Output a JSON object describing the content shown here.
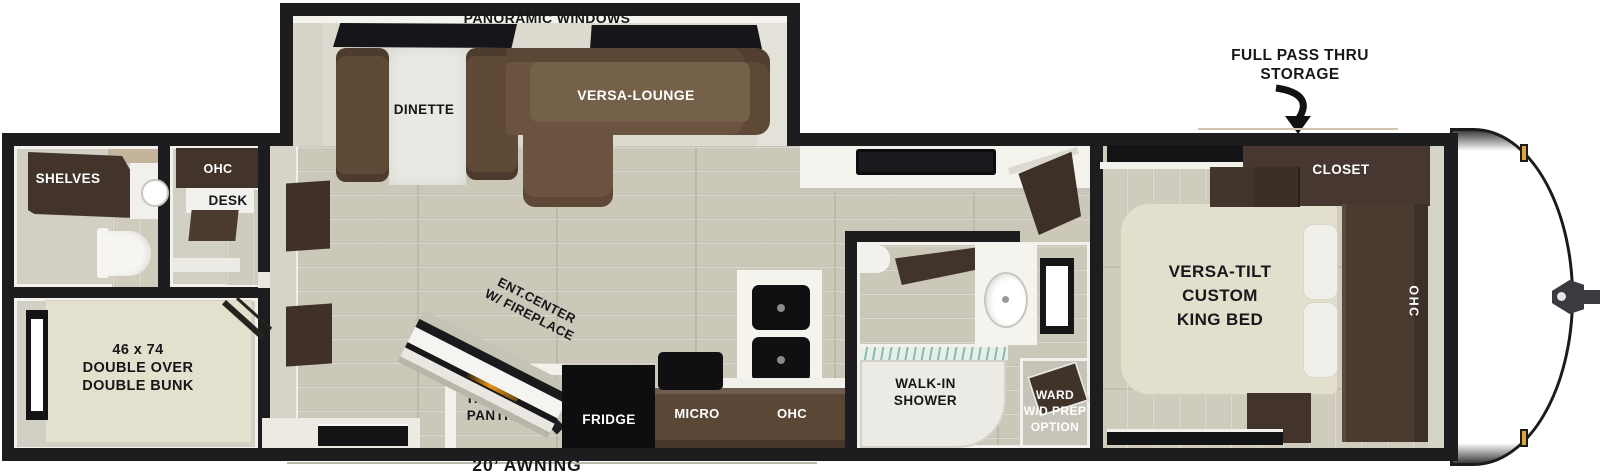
{
  "plan_title": "travel trailer floorplan",
  "colors": {
    "wall": "#1d1d1f",
    "floor": "#cbc7b9",
    "cabinet_dark": "#42342a",
    "sofa_brown": "#6b543f",
    "mattress_cream": "#e4e0ce",
    "appliance_black": "#101012",
    "clearance_light_gold": "#d8a53e",
    "fireplace_glow": "#e8920f"
  },
  "exterior": {
    "storage_line1": "FULL PASS THRU",
    "storage_line2": "STORAGE",
    "awning_label": "20’ AWNING"
  },
  "slideout": {
    "window_label": "PANORAMIC WINDOWS",
    "dinette": "DINETTE",
    "lounge": "VERSA-LOUNGE"
  },
  "rear_bath": {
    "shelves": "SHELVES"
  },
  "desk_area": {
    "ohc": "OHC",
    "desk": "DESK"
  },
  "bunk_room": {
    "line1": "46 x 74",
    "line2": "DOUBLE OVER",
    "line3": "DOUBLE BUNK"
  },
  "living": {
    "ent_line1": "ENT.CENTER",
    "ent_line2": "W/ FIREPLACE",
    "pantry_line1": "HIDDEN",
    "pantry_line2": "PANTRY"
  },
  "kitchen": {
    "fridge": "FRIDGE",
    "micro": "MICRO",
    "ohc": "OHC"
  },
  "bathroom": {
    "shower_line1": "WALK-IN",
    "shower_line2": "SHOWER",
    "ward_line1": "WARD",
    "ward_line2": "W/D PREP",
    "ward_line3": "OPTION"
  },
  "bedroom": {
    "closet": "CLOSET",
    "bed_line1": "VERSA-TILT",
    "bed_line2": "CUSTOM",
    "bed_line3": "KING BED",
    "ohc": "OHC"
  }
}
